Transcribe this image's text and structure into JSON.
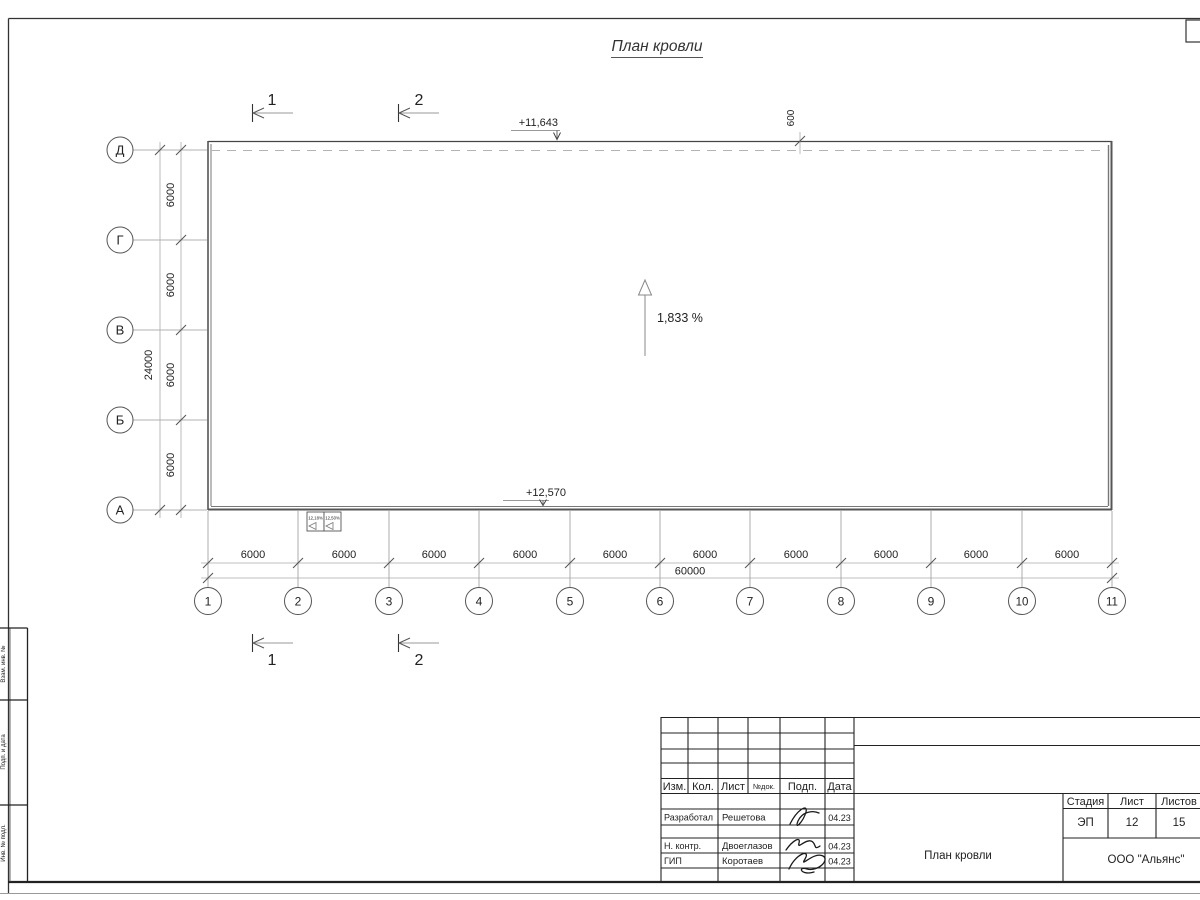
{
  "sheet": {
    "title": "План кровли",
    "company": "ООО \"Альянс\"",
    "stage_label": "Стадия",
    "sheet_label": "Лист",
    "sheets_label": "Листов",
    "stage": "ЭП",
    "sheet_no": "12",
    "sheets_total": "15",
    "title_block": {
      "headers": {
        "izm": "Изм.",
        "kol": "Кол.",
        "list": "Лист",
        "ndok": "№док.",
        "podp": "Подп.",
        "data": "Дата"
      },
      "rows": [
        {
          "role": "Разработал",
          "name": "Решетова",
          "date": "04.23"
        },
        {
          "role": "Н. контр.",
          "name": "Двоеглазов",
          "date": "04.23"
        },
        {
          "role": "ГИП",
          "name": "Коротаев",
          "date": "04.23"
        }
      ]
    },
    "side_labels": [
      "Взам. инв. №",
      "Подп. и дата",
      "Инв. № подл."
    ]
  },
  "plan": {
    "row_axes": [
      "Д",
      "Г",
      "В",
      "Б",
      "А"
    ],
    "col_axes": [
      "1",
      "2",
      "3",
      "4",
      "5",
      "6",
      "7",
      "8",
      "9",
      "10",
      "11"
    ],
    "row_dims": [
      "6000",
      "6000",
      "6000",
      "6000"
    ],
    "row_total": "24000",
    "col_dims": [
      "6000",
      "6000",
      "6000",
      "6000",
      "6000",
      "6000",
      "6000",
      "6000",
      "6000",
      "6000"
    ],
    "col_total": "60000",
    "elevation_top": "+11,643",
    "elevation_bottom": "+12,570",
    "parapet_offset": "600",
    "slope": "1,833 %",
    "section_labels": [
      "1",
      "2"
    ],
    "detail_boxes": [
      "12,18%",
      "12,50%"
    ]
  }
}
